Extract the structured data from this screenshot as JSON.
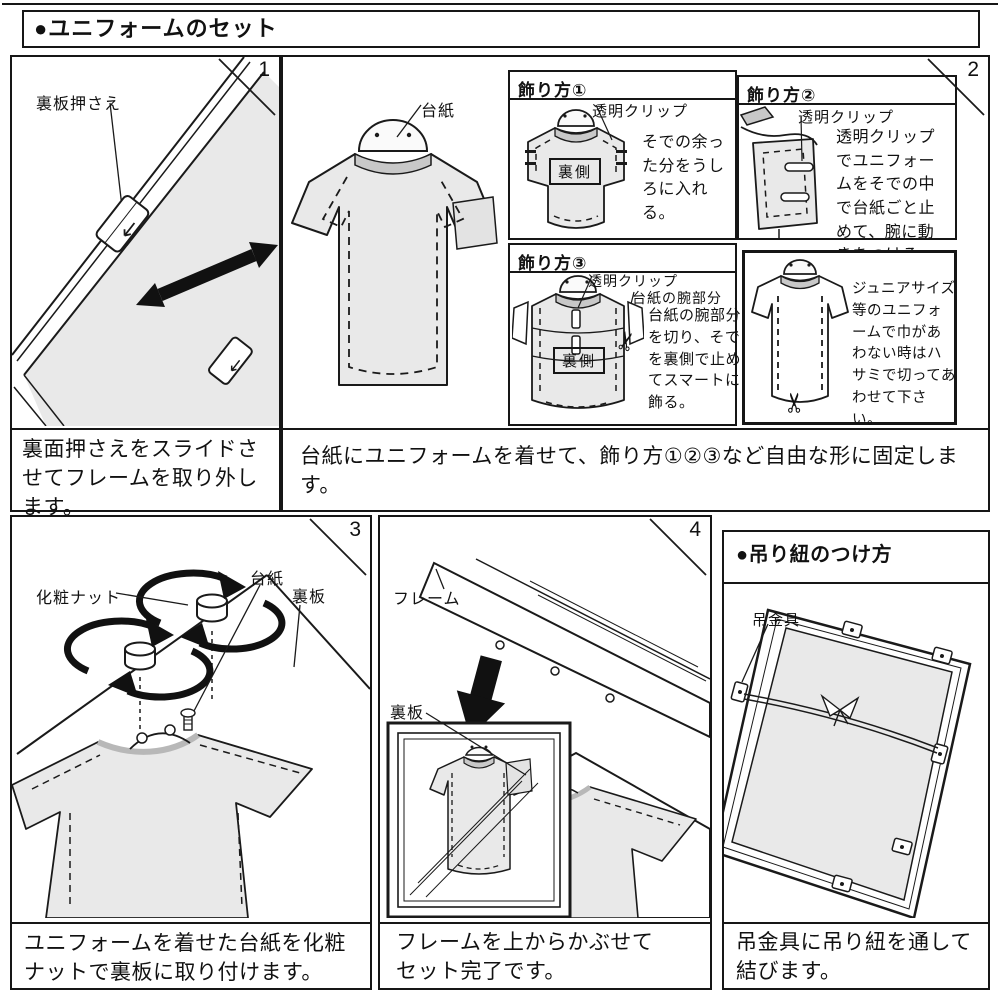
{
  "page": {
    "title": "●ユニフォームのセット"
  },
  "panel1": {
    "number": "1",
    "label_backboard_holder": "裏板押さえ",
    "caption": "裏面押さえをスライドさせてフレームを取り外します。"
  },
  "panel2": {
    "number": "2",
    "label_mat_board": "台紙",
    "caption": "台紙にユニフォームを着せて、飾り方①②③など自由な形に固定します。",
    "method1": {
      "header": "飾り方①",
      "label_clip": "透明クリップ",
      "label_back": "裏側",
      "note": "そでの余った分をうしろに入れる。"
    },
    "method2": {
      "header": "飾り方②",
      "label_clip": "透明クリップ",
      "note": "透明クリップでユニフォームをそでの中で台紙ごと止めて、腕に動きをつける。"
    },
    "method3": {
      "header": "飾り方③",
      "label_clip": "透明クリップ",
      "label_arm": "台紙の腕部分",
      "label_back": "裏側",
      "note": "台紙の腕部分を切り、そでを裏側で止めてスマートに飾る。"
    },
    "junior": {
      "note": "ジュニアサイズ等のユニフォームで巾があわない時はハサミで切ってあわせて下さい。"
    }
  },
  "panel3": {
    "number": "3",
    "label_nut": "化粧ナット",
    "label_mat_board": "台紙",
    "label_back_board": "裏板",
    "caption": "ユニフォームを着せた台紙を化粧ナットで裏板に取り付けます。"
  },
  "panel4": {
    "number": "4",
    "label_frame": "フレーム",
    "label_back_board": "裏板",
    "caption": "フレームを上からかぶせてセット完了です。"
  },
  "hanging": {
    "header": "●吊り紐のつけ方",
    "label_fitting": "吊金具",
    "caption": "吊金具に吊り紐を通して結びます。"
  },
  "icons": {
    "scissors": "✂"
  },
  "colors": {
    "ink": "#1a1a1a",
    "shirt_fill": "#e9e9e9",
    "paper": "#ffffff"
  }
}
